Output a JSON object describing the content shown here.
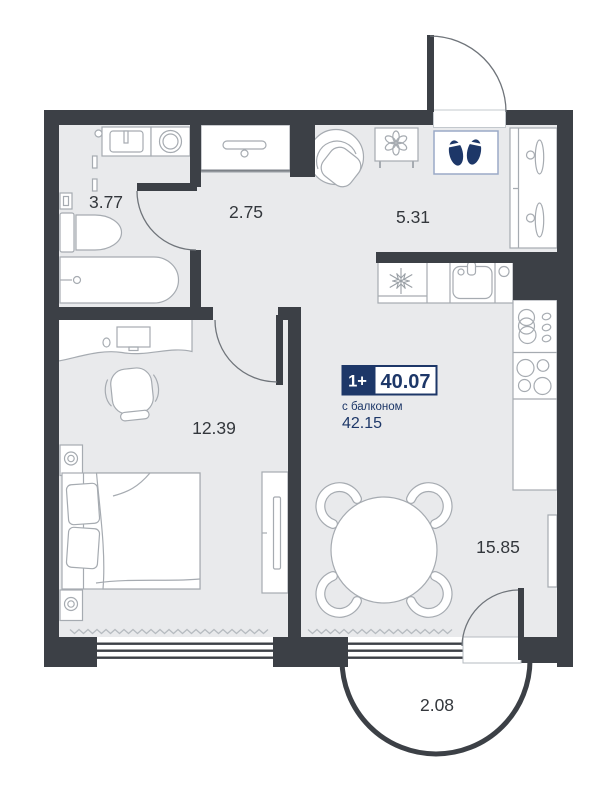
{
  "floor_plan": {
    "summary": {
      "rooms_badge": "1+",
      "total_area": "40.07",
      "balcony_note": "с балконом",
      "area_with_balcony": "42.15"
    },
    "rooms": {
      "bathroom": {
        "area": "3.77"
      },
      "hallway": {
        "area": "2.75"
      },
      "entry": {
        "area": "5.31"
      },
      "bedroom": {
        "area": "12.39"
      },
      "kitchen_living": {
        "area": "15.85"
      },
      "balcony": {
        "area": "2.08"
      }
    },
    "colors": {
      "wall": "#3c4046",
      "floor": "#e9eaec",
      "accent": "#1d3768",
      "outline": "#a6abb1"
    },
    "icons": {
      "entrance-footprints-icon": "two navy footprints marking entrance",
      "fridge-snowflake-icon": "snowflake on fridge",
      "plant-icon": "flower on side table",
      "hanger-icon": "clothes hangers in wardrobe",
      "coat-rail-icon": "hanger rail in hall closet",
      "stove-burners-icon": "four burner circles",
      "dish-rack-icon": "stacked plates and drops"
    }
  }
}
